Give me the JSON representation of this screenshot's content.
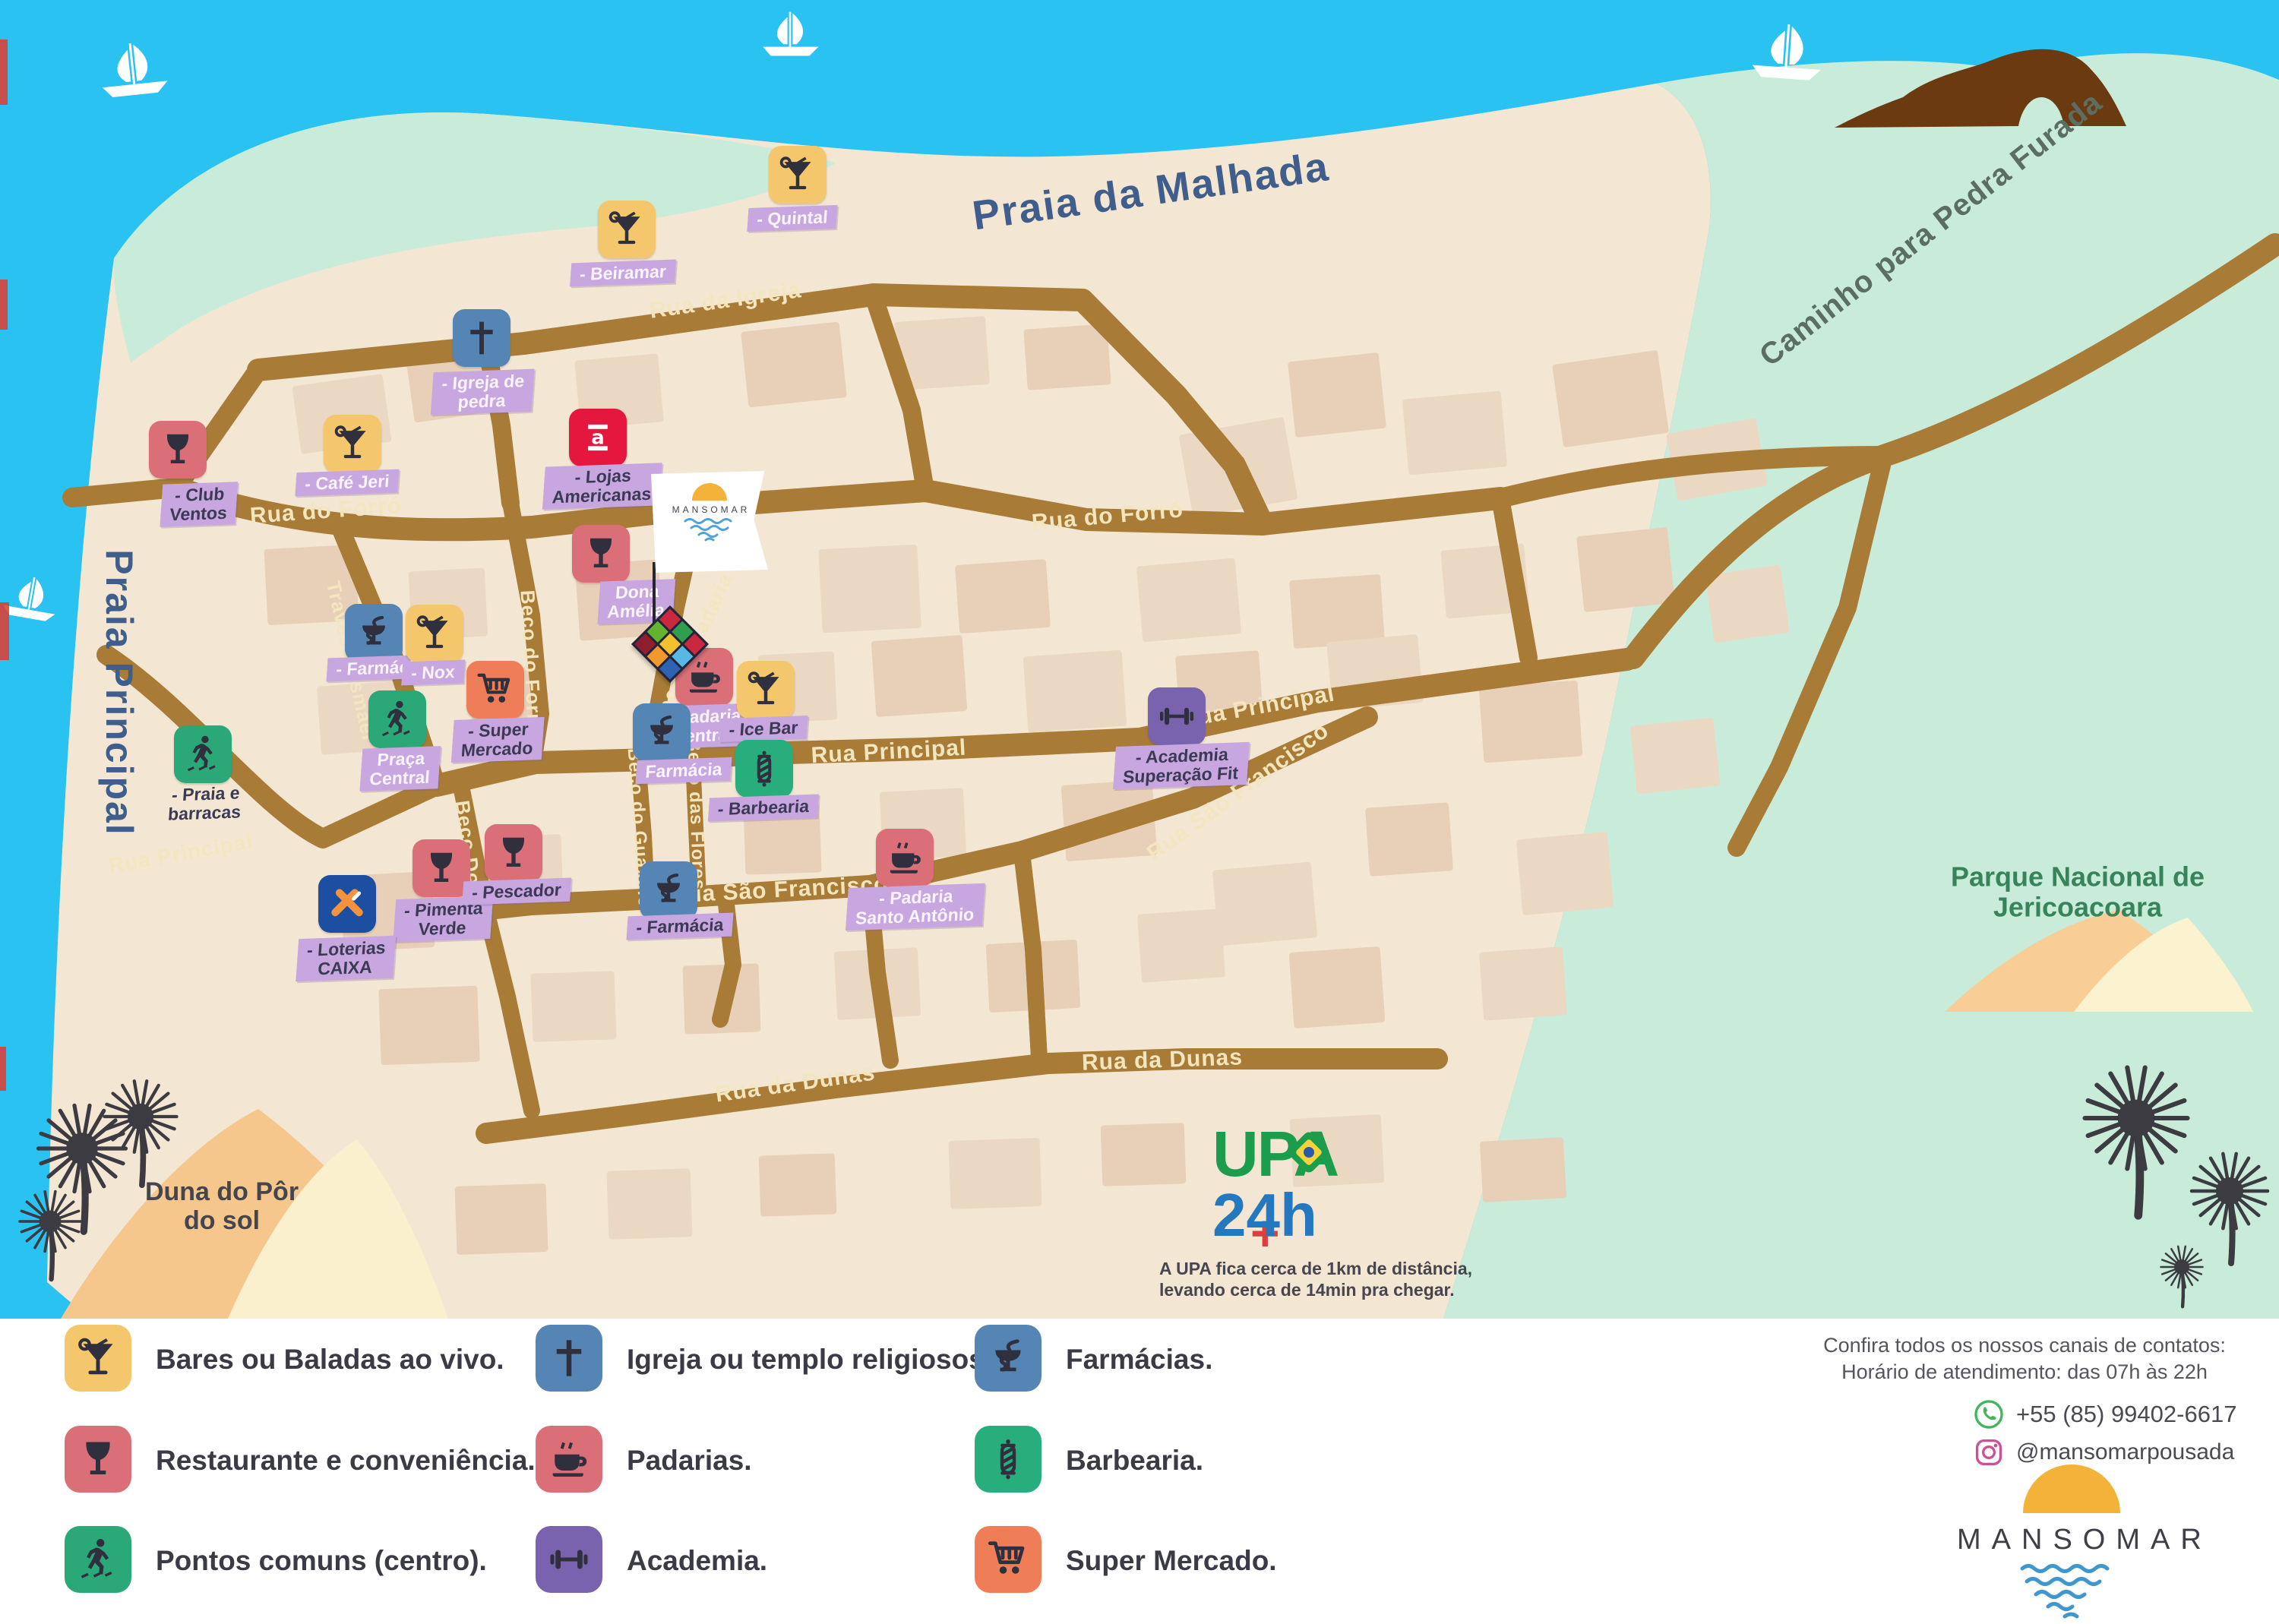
{
  "title": "Mapa MANSOMAR — Jericoacoara",
  "colors": {
    "water": "#29C2F1",
    "sand": "#F3E6D2",
    "vegetation": "#C8ECD9",
    "road": "#A87C36",
    "label_tag": "#C8A6DF",
    "brand_sun": "#F3B33A",
    "brand_waves": "#4FA3D8"
  },
  "map": {
    "areas": {
      "praia_malhada": "Praia da Malhada",
      "praia_principal": "Praia Principal",
      "parque_line1": "Parque Nacional de",
      "parque_line2": "Jericoacoara",
      "duna_line1": "Duna do Pôr",
      "duna_line2": "do sol"
    },
    "flag": {
      "brand": "MANSOMAR"
    },
    "upa": {
      "title": "UPA",
      "subtitle": "24h",
      "caption_line1": "A UPA fica cerca de 1km de distância,",
      "caption_line2": "levando cerca de 14min pra chegar."
    },
    "streets": [
      {
        "id": "rua-da-igreja",
        "label": "Rua da Igreja"
      },
      {
        "id": "rua-do-forro-oeste",
        "label": "Rua do Forró"
      },
      {
        "id": "rua-do-forro-leste",
        "label": "Rua do Forró"
      },
      {
        "id": "travessa-ismael",
        "label": "Travessa Ismael"
      },
      {
        "id": "beco-do-forro",
        "label": "Beco do Forró"
      },
      {
        "id": "beco-da-padaria",
        "label": "Beco da Padaria"
      },
      {
        "id": "rua-principal-oeste",
        "label": "Rua Principal"
      },
      {
        "id": "rua-principal-centro",
        "label": "Rua Principal"
      },
      {
        "id": "rua-principal-leste",
        "label": "Rua Principal"
      },
      {
        "id": "rua-sao-francisco-oeste",
        "label": "Rua São Francisco"
      },
      {
        "id": "rua-sao-francisco-leste",
        "label": "Rua São Francisco"
      },
      {
        "id": "beco-doce",
        "label": "Beco Doce"
      },
      {
        "id": "beco-do-guaxelo",
        "label": "Beco do Guaxelo"
      },
      {
        "id": "beco-das-flores",
        "label": "Beco das Flores"
      },
      {
        "id": "rua-da-dunas-oeste",
        "label": "Rua da Dunas"
      },
      {
        "id": "rua-da-dunas-leste",
        "label": "Rua da Dunas"
      },
      {
        "id": "caminho-pedra-furada",
        "label": "Caminho para Pedra Furada"
      }
    ],
    "pois": [
      {
        "id": "beiramar",
        "icon": "cocktail",
        "color": "#F5C76D",
        "tone": "light",
        "bg": true,
        "label_lines": [
          "- Beiramar"
        ]
      },
      {
        "id": "quintal",
        "icon": "cocktail",
        "color": "#F5C76D",
        "tone": "light",
        "bg": true,
        "label_lines": [
          "- Quintal"
        ]
      },
      {
        "id": "igreja-de-pedra",
        "icon": "cross",
        "color": "#5585B4",
        "tone": "light",
        "bg": true,
        "label_lines": [
          "- Igreja de",
          "pedra"
        ]
      },
      {
        "id": "club-ventos",
        "icon": "wine",
        "color": "#DB6F78",
        "tone": "dark",
        "bg": true,
        "label_lines": [
          "- Club",
          "Ventos"
        ]
      },
      {
        "id": "cafe-jeri",
        "icon": "cocktail",
        "color": "#F5C76D",
        "tone": "light",
        "bg": true,
        "label_lines": [
          "- Café Jeri"
        ]
      },
      {
        "id": "lojas-americanas",
        "icon": "americanas",
        "color": "#E5173F",
        "tone": "dark",
        "bg": true,
        "label_lines": [
          "- Lojas",
          "Americanas"
        ]
      },
      {
        "id": "dona-amelia",
        "icon": "wine",
        "color": "#DB6F78",
        "tone": "light",
        "bg": true,
        "label_lines": [
          "Dona",
          "Amélia"
        ]
      },
      {
        "id": "farmacia-travessa",
        "icon": "hygieia",
        "color": "#5585B4",
        "tone": "light",
        "bg": true,
        "label_lines": [
          "- Farmácia"
        ]
      },
      {
        "id": "nox",
        "icon": "cocktail",
        "color": "#F5C76D",
        "tone": "light",
        "bg": true,
        "label_lines": [
          "- Nox"
        ]
      },
      {
        "id": "super-mercado",
        "icon": "cart",
        "color": "#EF7E58",
        "tone": "dark",
        "bg": true,
        "label_lines": [
          "- Super",
          "Mercado"
        ]
      },
      {
        "id": "praca-central",
        "icon": "walk",
        "color": "#2BA878",
        "tone": "light",
        "bg": true,
        "label_lines": [
          "Praça",
          "Central"
        ]
      },
      {
        "id": "praia-e-barracas",
        "icon": "walk",
        "color": "#2BA878",
        "tone": "dark",
        "bg": false,
        "label_lines": [
          "- Praia e",
          "barracas"
        ]
      },
      {
        "id": "padaria-central",
        "icon": "coffee",
        "color": "#DB6F78",
        "tone": "light",
        "bg": true,
        "label_lines": [
          "- Padaria",
          "Central"
        ]
      },
      {
        "id": "farmacia-rua-principal",
        "icon": "hygieia",
        "color": "#5585B4",
        "tone": "light",
        "bg": true,
        "label_lines": [
          "Farmácia"
        ]
      },
      {
        "id": "ice-bar",
        "icon": "cocktail",
        "color": "#F5C76D",
        "tone": "dark",
        "bg": true,
        "label_lines": [
          "- Ice Bar"
        ]
      },
      {
        "id": "barbearia",
        "icon": "barber",
        "color": "#28AE7C",
        "tone": "dark",
        "bg": true,
        "label_lines": [
          "- Barbearia"
        ]
      },
      {
        "id": "academia-superacao-fit",
        "icon": "dumbbell",
        "color": "#7963AF",
        "tone": "dark",
        "bg": true,
        "label_lines": [
          "- Academia",
          "Superação Fit"
        ]
      },
      {
        "id": "pimenta-verde",
        "icon": "wine",
        "color": "#DB6F78",
        "tone": "dark",
        "bg": true,
        "label_lines": [
          "- Pimenta",
          "Verde"
        ]
      },
      {
        "id": "pescador",
        "icon": "wine",
        "color": "#DB6F78",
        "tone": "dark",
        "bg": true,
        "label_lines": [
          "- Pescador"
        ]
      },
      {
        "id": "loterias-caixa",
        "icon": "caixa",
        "color": "#1C4FA1",
        "tone": "dark",
        "bg": true,
        "label_lines": [
          "- Loterias",
          "CAIXA"
        ]
      },
      {
        "id": "farmacia-sao-francisco",
        "icon": "hygieia",
        "color": "#5585B4",
        "tone": "dark",
        "bg": true,
        "label_lines": [
          "- Farmácia"
        ]
      },
      {
        "id": "padaria-santo-antonio",
        "icon": "coffee",
        "color": "#DB6F78",
        "tone": "light",
        "bg": true,
        "label_lines": [
          "- Padaria",
          "Santo Antônio"
        ]
      }
    ]
  },
  "legend": {
    "items": [
      {
        "icon": "cocktail",
        "color": "#F5C76D",
        "label": "Bares ou Baladas ao vivo."
      },
      {
        "icon": "wine",
        "color": "#DB6F78",
        "label": "Restaurante e conveniência."
      },
      {
        "icon": "walk",
        "color": "#2BA878",
        "label": "Pontos comuns (centro)."
      },
      {
        "icon": "cross",
        "color": "#5585B4",
        "label": "Igreja ou templo religiosos."
      },
      {
        "icon": "coffee",
        "color": "#DB6F78",
        "label": "Padarias."
      },
      {
        "icon": "dumbbell",
        "color": "#7963AF",
        "label": "Academia."
      },
      {
        "icon": "hygieia",
        "color": "#5585B4",
        "label": "Farmácias."
      },
      {
        "icon": "barber",
        "color": "#28AE7C",
        "label": "Barbearia."
      },
      {
        "icon": "cart",
        "color": "#EF7E58",
        "label": "Super Mercado."
      }
    ]
  },
  "contact": {
    "heading_line1": "Confira todos os nossos canais de contatos:",
    "heading_line2": "Horário de atendimento: das 07h às 22h",
    "whatsapp": "+55 (85) 99402-6617",
    "instagram": "@mansomarpousada"
  },
  "brand": {
    "name": "MANSOMAR"
  }
}
